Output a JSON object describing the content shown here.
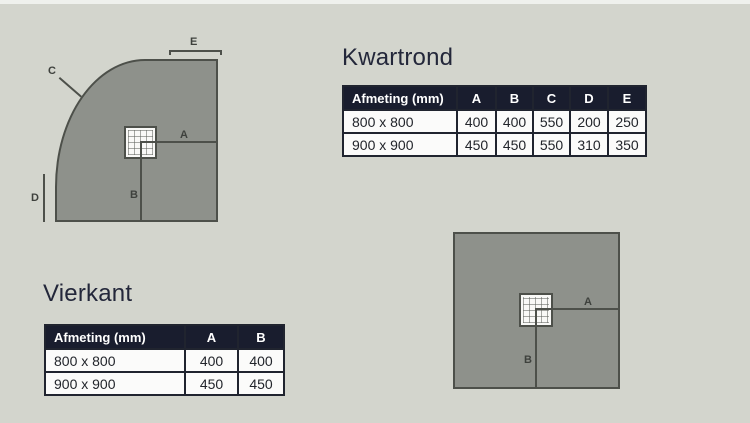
{
  "kwartrond": {
    "title": "Kwartrond",
    "table": {
      "headers": [
        "Afmeting (mm)",
        "A",
        "B",
        "C",
        "D",
        "E"
      ],
      "rows": [
        {
          "size": "800 x 800",
          "values": [
            "400",
            "400",
            "550",
            "200",
            "250"
          ]
        },
        {
          "size": "900 x 900",
          "values": [
            "450",
            "450",
            "550",
            "310",
            "350"
          ]
        }
      ]
    },
    "diagram_labels": {
      "A": "A",
      "B": "B",
      "C": "C",
      "D": "D",
      "E": "E"
    }
  },
  "vierkant": {
    "title": "Vierkant",
    "table": {
      "headers": [
        "Afmeting (mm)",
        "A",
        "B"
      ],
      "rows": [
        {
          "size": "800 x 800",
          "values": [
            "400",
            "400"
          ]
        },
        {
          "size": "900 x 900",
          "values": [
            "450",
            "450"
          ]
        }
      ]
    },
    "diagram_labels": {
      "A": "A",
      "B": "B"
    }
  },
  "colors": {
    "background": "#d3d5cd",
    "tray_fill": "#8e918b",
    "tray_stroke": "#4d504a",
    "table_header_bg": "#191d2e",
    "table_border": "#20242f",
    "cell_bg": "#fbfbfa",
    "title_text": "#23273a"
  }
}
